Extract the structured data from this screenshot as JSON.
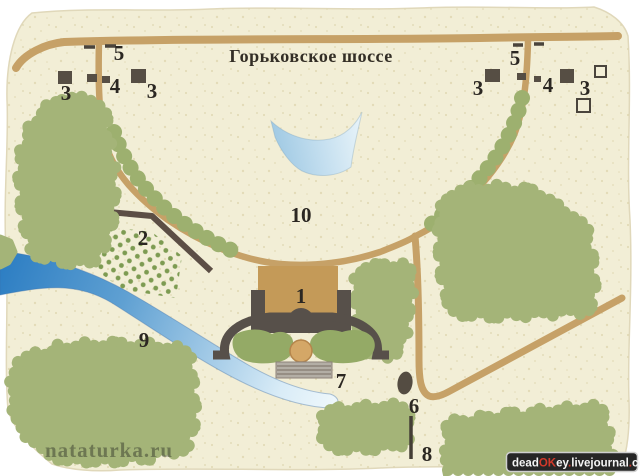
{
  "map": {
    "highway_label": "Горьковское шоссе",
    "markers": {
      "left_gate": "5",
      "left_building_a": "3",
      "left_building_pair": "4",
      "left_building_b": "3",
      "right_gate": "5",
      "right_building_a": "3",
      "right_building_pair": "4",
      "right_building_b": "3",
      "park": "10",
      "alley": "2",
      "river": "9",
      "main_house": "1",
      "stairs": "7",
      "oval": "6",
      "line": "8"
    },
    "colors": {
      "paper": "#f2eed6",
      "speckle": "#dcd3ab",
      "road": "#c6a167",
      "forest_green": "#a4b478",
      "orchard_green": "#7d9b52",
      "river_blue": "#2d7ec3",
      "pond_blue": "#9cc7e2",
      "structure_gray": "#57504a",
      "house_tan": "#c49a58",
      "fountain_tan": "#d4a767",
      "label_ink": "#2b2722"
    }
  },
  "watermarks": {
    "site_name": "nataturka.ru",
    "badge": {
      "parts": [
        {
          "text": "dead",
          "color": "#f5f5f5"
        },
        {
          "text": "OK",
          "color": "#d2392a"
        },
        {
          "text": "ey",
          "color": "#f5f5f5"
        },
        {
          "text": ".",
          "color": "#d2392a"
        },
        {
          "text": "livejournal",
          "color": "#f5f5f5"
        },
        {
          "text": ".",
          "color": "#d2392a"
        },
        {
          "text": "com",
          "color": "#f5f5f5"
        }
      ]
    }
  }
}
